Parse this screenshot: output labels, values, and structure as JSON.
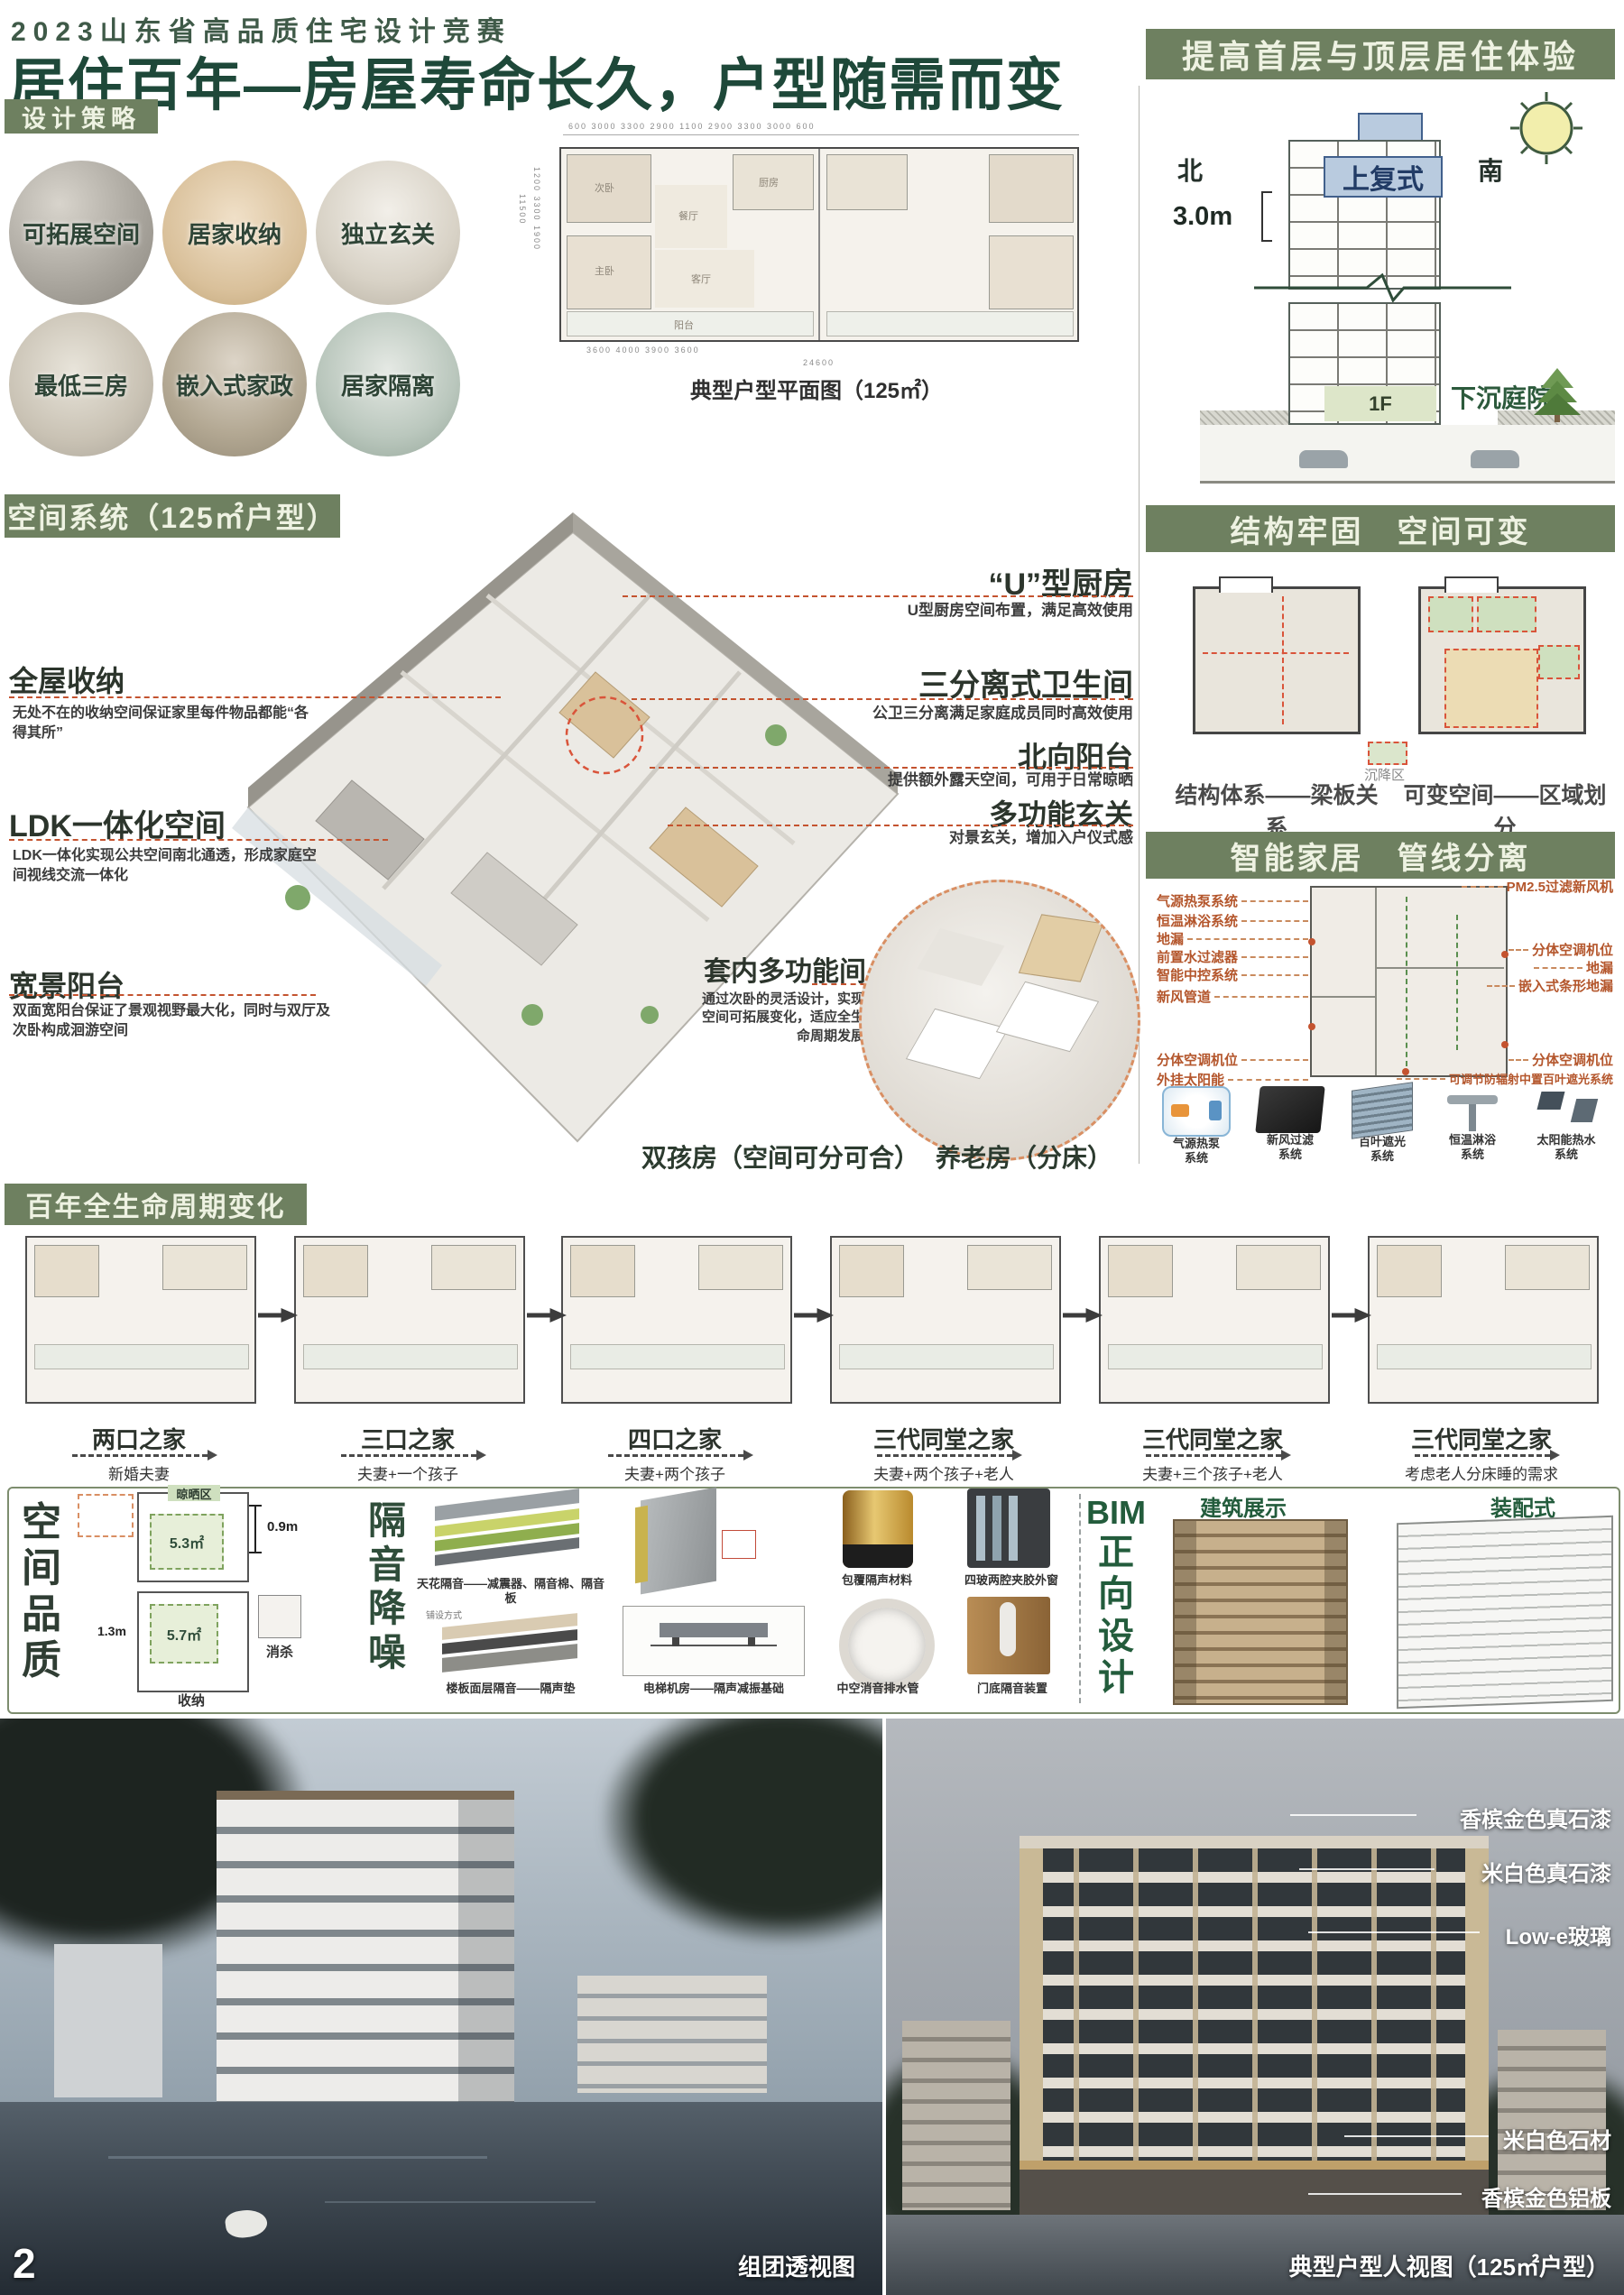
{
  "page": {
    "number": "2"
  },
  "header": {
    "competition": "2023山东省高品质住宅设计竞赛",
    "title": "居住百年—房屋寿命长久，户型随需而变"
  },
  "design_strategy": {
    "heading": "设计策略",
    "items": [
      {
        "label": "可拓展空间"
      },
      {
        "label": "居家收纳"
      },
      {
        "label": "独立玄关"
      },
      {
        "label": "最低三房"
      },
      {
        "label": "嵌入式家政"
      },
      {
        "label": "居家隔离"
      }
    ]
  },
  "typical_plan": {
    "caption": "典型户型平面图（125㎡）",
    "dims": {
      "top": "600   3000   3300   2900   1100   2900   3300   3000   600",
      "bottom": "3600      4000      3900      3600",
      "bottom_total": "24600",
      "left": "1200 3300 1900",
      "left_total": "11500"
    },
    "rooms": {
      "r1": "次卧",
      "r2": "厨房",
      "r3": "餐厅",
      "r4": "客厅",
      "r5": "主卧",
      "r6": "阳台"
    }
  },
  "top_right": {
    "heading": "提高首层与顶层居住体验",
    "north": "北",
    "south": "南",
    "height_label": "3.0m",
    "duplex": "上复式",
    "first_floor": "1F",
    "activity_hall": "活动厅",
    "sunken_courtyard": "下沉庭院"
  },
  "structure_panel": {
    "heading": "结构牢固　空间可变",
    "caption_left": "结构体系——梁板关系",
    "caption_right": "可变空间——区域划分",
    "legend": "沉降区"
  },
  "smart_home": {
    "heading": "智能家居　管线分离",
    "labels_left": [
      "气源热泵系统",
      "恒温淋浴系统",
      "地漏",
      "前置水过滤器",
      "智能中控系统",
      "新风管道",
      "分体空调机位",
      "外挂太阳能"
    ],
    "labels_right": [
      "PM2.5过滤新风机",
      "分体空调机位",
      "地漏",
      "嵌入式条形地漏",
      "分体空调机位",
      "可调节防辐射中置百叶遮光系统"
    ],
    "systems": [
      {
        "line1": "气源热泵",
        "line2": "系统"
      },
      {
        "line1": "新风过滤",
        "line2": "系统"
      },
      {
        "line1": "百叶遮光",
        "line2": "系统"
      },
      {
        "line1": "恒温淋浴",
        "line2": "系统"
      },
      {
        "line1": "太阳能热水",
        "line2": "系统"
      }
    ]
  },
  "space_system": {
    "heading": "空间系统（125㎡户型）",
    "callouts_left": [
      {
        "title": "全屋收纳",
        "desc": "无处不在的收纳空间保证家里每件物品都能“各得其所”"
      },
      {
        "title": "LDK一体化空间",
        "desc": "LDK一体化实现公共空间南北通透，形成家庭空间视线交流一体化"
      },
      {
        "title": "宽景阳台",
        "desc": "双面宽阳台保证了景观视野最大化，同时与双厅及次卧构成洄游空间"
      }
    ],
    "callouts_right": [
      {
        "title": "“U”型厨房",
        "desc": "U型厨房空间布置，满足高效使用"
      },
      {
        "title": "三分离式卫生间",
        "desc": "公卫三分离满足家庭成员同时高效使用"
      },
      {
        "title": "北向阳台",
        "desc": "提供额外露天空间，可用于日常晾晒"
      },
      {
        "title": "多功能玄关",
        "desc": "对景玄关，增加入户仪式感"
      }
    ],
    "flex_room": {
      "title": "套内多功能间",
      "desc": "通过次卧的灵活设计，实现空间可拓展变化，适应全生命周期发展"
    },
    "labels_bottom": [
      "双孩房（空间可分可合）",
      "养老房（分床）"
    ]
  },
  "lifecycle": {
    "heading": "百年全生命周期变化",
    "stages": [
      {
        "title": "两口之家",
        "sub": "新婚夫妻"
      },
      {
        "title": "三口之家",
        "sub": "夫妻+一个孩子"
      },
      {
        "title": "四口之家",
        "sub": "夫妻+两个孩子"
      },
      {
        "title": "三代同堂之家",
        "sub": "夫妻+两个孩子+老人"
      },
      {
        "title": "三代同堂之家",
        "sub": "夫妻+三个孩子+老人"
      },
      {
        "title": "三代同堂之家",
        "sub": "考虑老人分床睡的需求"
      }
    ]
  },
  "quality": {
    "heading_chars": [
      "空",
      "间",
      "品",
      "质"
    ],
    "dry_area": "晾晒区",
    "area1": "5.3㎡",
    "dim1": "0.9m",
    "area2": "5.7㎡",
    "dim2": "1.3m",
    "disinfect": "消杀",
    "storage": "收纳"
  },
  "acoustic": {
    "heading_chars": [
      "隔",
      "音",
      "降",
      "噪"
    ],
    "captions": {
      "ceiling": "天花隔音——减震器、隔音棉、隔音板",
      "floor": "楼板面层隔音——隔声垫",
      "laying": "铺设方式",
      "elevator": "电梯机房——隔声减振基础",
      "pipe_wrap": "包覆隔声材料",
      "window": "四玻两腔夹胶外窗",
      "drain": "中空消音排水管",
      "door": "门底隔音装置"
    }
  },
  "bim": {
    "heading_line1": "BIM",
    "heading_chars": [
      "正",
      "向",
      "设",
      "计"
    ],
    "label_left": "建筑展示",
    "label_right": "装配式"
  },
  "renders": {
    "left_caption": "组团透视图",
    "right_caption": "典型户型人视图（125㎡户型）",
    "material_callouts": [
      "香槟金色真石漆",
      "米白色真石漆",
      "Low-e玻璃",
      "米白色石材",
      "香槟金色铝板"
    ]
  },
  "colors": {
    "bar_green": "#6e8060",
    "title_green": "#1e4839",
    "accent_orange": "#c4532f",
    "label_orange": "#b4562c",
    "deep_green": "#2c5a3c",
    "duplex_blue": "#b9cbdf",
    "zone_green": "#dbe4c6"
  }
}
